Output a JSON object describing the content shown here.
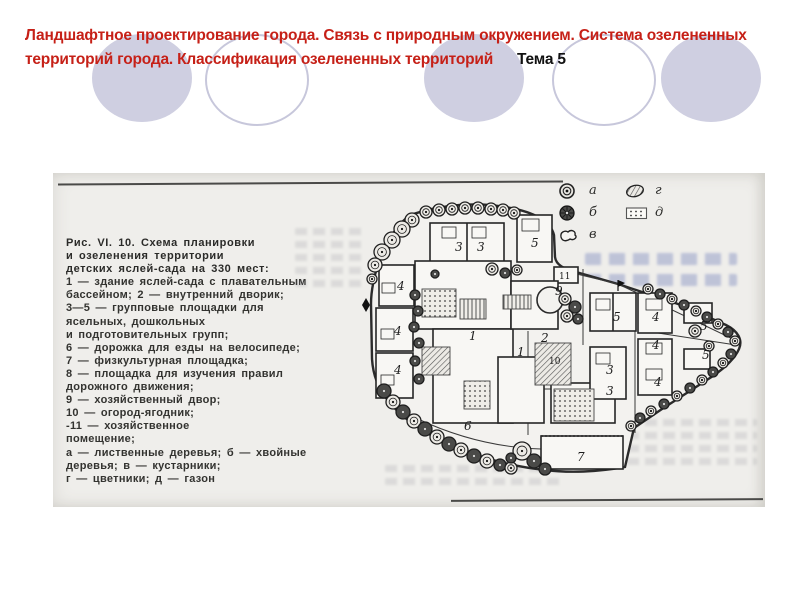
{
  "slide": {
    "title": {
      "red_line1": "Ландшафтное проектирование города. Связь с природным окружением.  Система озелененных",
      "red_line2": "территорий города. Классификация озелененных территорий",
      "topic": "Тема 5"
    },
    "colors": {
      "title_red": "#c62017",
      "circle_fill": "#cfcfe1",
      "circle_stroke": "#c7c7db",
      "scan_paper": "#efeeeb",
      "plan_ink": "#2b2b2b"
    }
  },
  "figure": {
    "caption_lines": [
      "Рис. VI. 10. Схема планировки",
      "и озеленения территории",
      "детских яслей-сада на 330 мест:",
      "1 — здание яслей-сада с плавательным",
      "бассейном;  2 — внутренний  дворик;",
      "3—5 — групповые площадки для",
      "ясельных, дошкольных",
      "и подготовительных групп;",
      "6 — дорожка для езды на велосипеде;",
      "7 — физкультурная площадка;",
      "8 — площадка для изучения правил",
      "дорожного движения;",
      "9 — хозяйственный двор;",
      "10 — огород-ягодник;",
      "-11 — хозяйственное",
      "помещение;",
      "а — лиственные деревья;  б — хвойные",
      "деревья; в — кустарники;",
      "г — цветники; д — газон"
    ],
    "legend": [
      {
        "symbol": "deciduous",
        "label": "а"
      },
      {
        "symbol": "flowerbed",
        "label": "г"
      },
      {
        "symbol": "conifer",
        "label": "б"
      },
      {
        "symbol": "lawn",
        "label": "д"
      },
      {
        "symbol": "shrub",
        "label": "в"
      }
    ],
    "plan_labels": [
      {
        "t": "3",
        "x": 457,
        "y": 252
      },
      {
        "t": "3",
        "x": 479,
        "y": 252
      },
      {
        "t": "5",
        "x": 533,
        "y": 248
      },
      {
        "t": "4",
        "x": 399,
        "y": 291
      },
      {
        "t": "4",
        "x": 396,
        "y": 336
      },
      {
        "t": "4",
        "x": 396,
        "y": 375
      },
      {
        "t": "1",
        "x": 471,
        "y": 341
      },
      {
        "t": "1",
        "x": 519,
        "y": 357
      },
      {
        "t": "9",
        "x": 557,
        "y": 296
      },
      {
        "t": "11",
        "x": 561,
        "y": 280
      },
      {
        "t": "5",
        "x": 615,
        "y": 322
      },
      {
        "t": "4",
        "x": 654,
        "y": 322
      },
      {
        "t": "5",
        "x": 702,
        "y": 331
      },
      {
        "t": "4",
        "x": 654,
        "y": 350
      },
      {
        "t": "5",
        "x": 704,
        "y": 360
      },
      {
        "t": "3",
        "x": 608,
        "y": 375
      },
      {
        "t": "3",
        "x": 608,
        "y": 396
      },
      {
        "t": "4",
        "x": 656,
        "y": 387
      },
      {
        "t": "10",
        "x": 551,
        "y": 365
      },
      {
        "t": "2",
        "x": 543,
        "y": 343
      },
      {
        "t": "6",
        "x": 466,
        "y": 431
      },
      {
        "t": "7",
        "x": 579,
        "y": 462
      }
    ],
    "plan_trees": [
      [
        428,
        213,
        6,
        "a"
      ],
      [
        441,
        211,
        6,
        "a"
      ],
      [
        454,
        210,
        6,
        "a"
      ],
      [
        467,
        209,
        6,
        "a"
      ],
      [
        480,
        209,
        6,
        "a"
      ],
      [
        493,
        210,
        6,
        "a"
      ],
      [
        505,
        211,
        6,
        "a"
      ],
      [
        516,
        214,
        6,
        "a"
      ],
      [
        414,
        221,
        7,
        "a"
      ],
      [
        404,
        230,
        8,
        "a"
      ],
      [
        394,
        241,
        8,
        "a"
      ],
      [
        384,
        253,
        8,
        "a"
      ],
      [
        377,
        266,
        7,
        "a"
      ],
      [
        374,
        280,
        5,
        "a"
      ],
      [
        417,
        296,
        5,
        "b"
      ],
      [
        420,
        312,
        5,
        "b"
      ],
      [
        416,
        328,
        5,
        "b"
      ],
      [
        421,
        344,
        5,
        "b"
      ],
      [
        417,
        362,
        5,
        "b"
      ],
      [
        421,
        380,
        5,
        "b"
      ],
      [
        386,
        392,
        7,
        "b"
      ],
      [
        395,
        403,
        7,
        "a"
      ],
      [
        405,
        413,
        7,
        "b"
      ],
      [
        416,
        422,
        7,
        "a"
      ],
      [
        427,
        430,
        7,
        "b"
      ],
      [
        439,
        438,
        7,
        "a"
      ],
      [
        451,
        445,
        7,
        "b"
      ],
      [
        463,
        451,
        7,
        "a"
      ],
      [
        476,
        457,
        7,
        "b"
      ],
      [
        489,
        462,
        7,
        "a"
      ],
      [
        502,
        466,
        6,
        "b"
      ],
      [
        513,
        469,
        6,
        "a"
      ],
      [
        524,
        452,
        9,
        "a"
      ],
      [
        536,
        462,
        7,
        "b"
      ],
      [
        513,
        459,
        5,
        "b"
      ],
      [
        547,
        470,
        6,
        "b"
      ],
      [
        650,
        290,
        5,
        "a"
      ],
      [
        662,
        295,
        5,
        "b"
      ],
      [
        674,
        300,
        5,
        "a"
      ],
      [
        686,
        306,
        5,
        "b"
      ],
      [
        698,
        312,
        5,
        "a"
      ],
      [
        709,
        318,
        5,
        "b"
      ],
      [
        720,
        325,
        5,
        "a"
      ],
      [
        730,
        333,
        5,
        "b"
      ],
      [
        737,
        342,
        5,
        "a"
      ],
      [
        733,
        355,
        5,
        "b"
      ],
      [
        725,
        364,
        5,
        "a"
      ],
      [
        715,
        373,
        5,
        "b"
      ],
      [
        704,
        381,
        5,
        "a"
      ],
      [
        692,
        389,
        5,
        "b"
      ],
      [
        679,
        397,
        5,
        "a"
      ],
      [
        666,
        405,
        5,
        "b"
      ],
      [
        653,
        412,
        5,
        "a"
      ],
      [
        642,
        419,
        5,
        "b"
      ],
      [
        633,
        427,
        5,
        "a"
      ],
      [
        697,
        332,
        6,
        "a"
      ],
      [
        711,
        347,
        5,
        "a"
      ],
      [
        567,
        300,
        6,
        "a"
      ],
      [
        577,
        308,
        6,
        "b"
      ],
      [
        569,
        317,
        6,
        "a"
      ],
      [
        580,
        320,
        5,
        "b"
      ],
      [
        494,
        270,
        6,
        "a"
      ],
      [
        507,
        274,
        5,
        "b"
      ],
      [
        519,
        271,
        5,
        "a"
      ],
      [
        437,
        275,
        4,
        "b"
      ]
    ]
  }
}
